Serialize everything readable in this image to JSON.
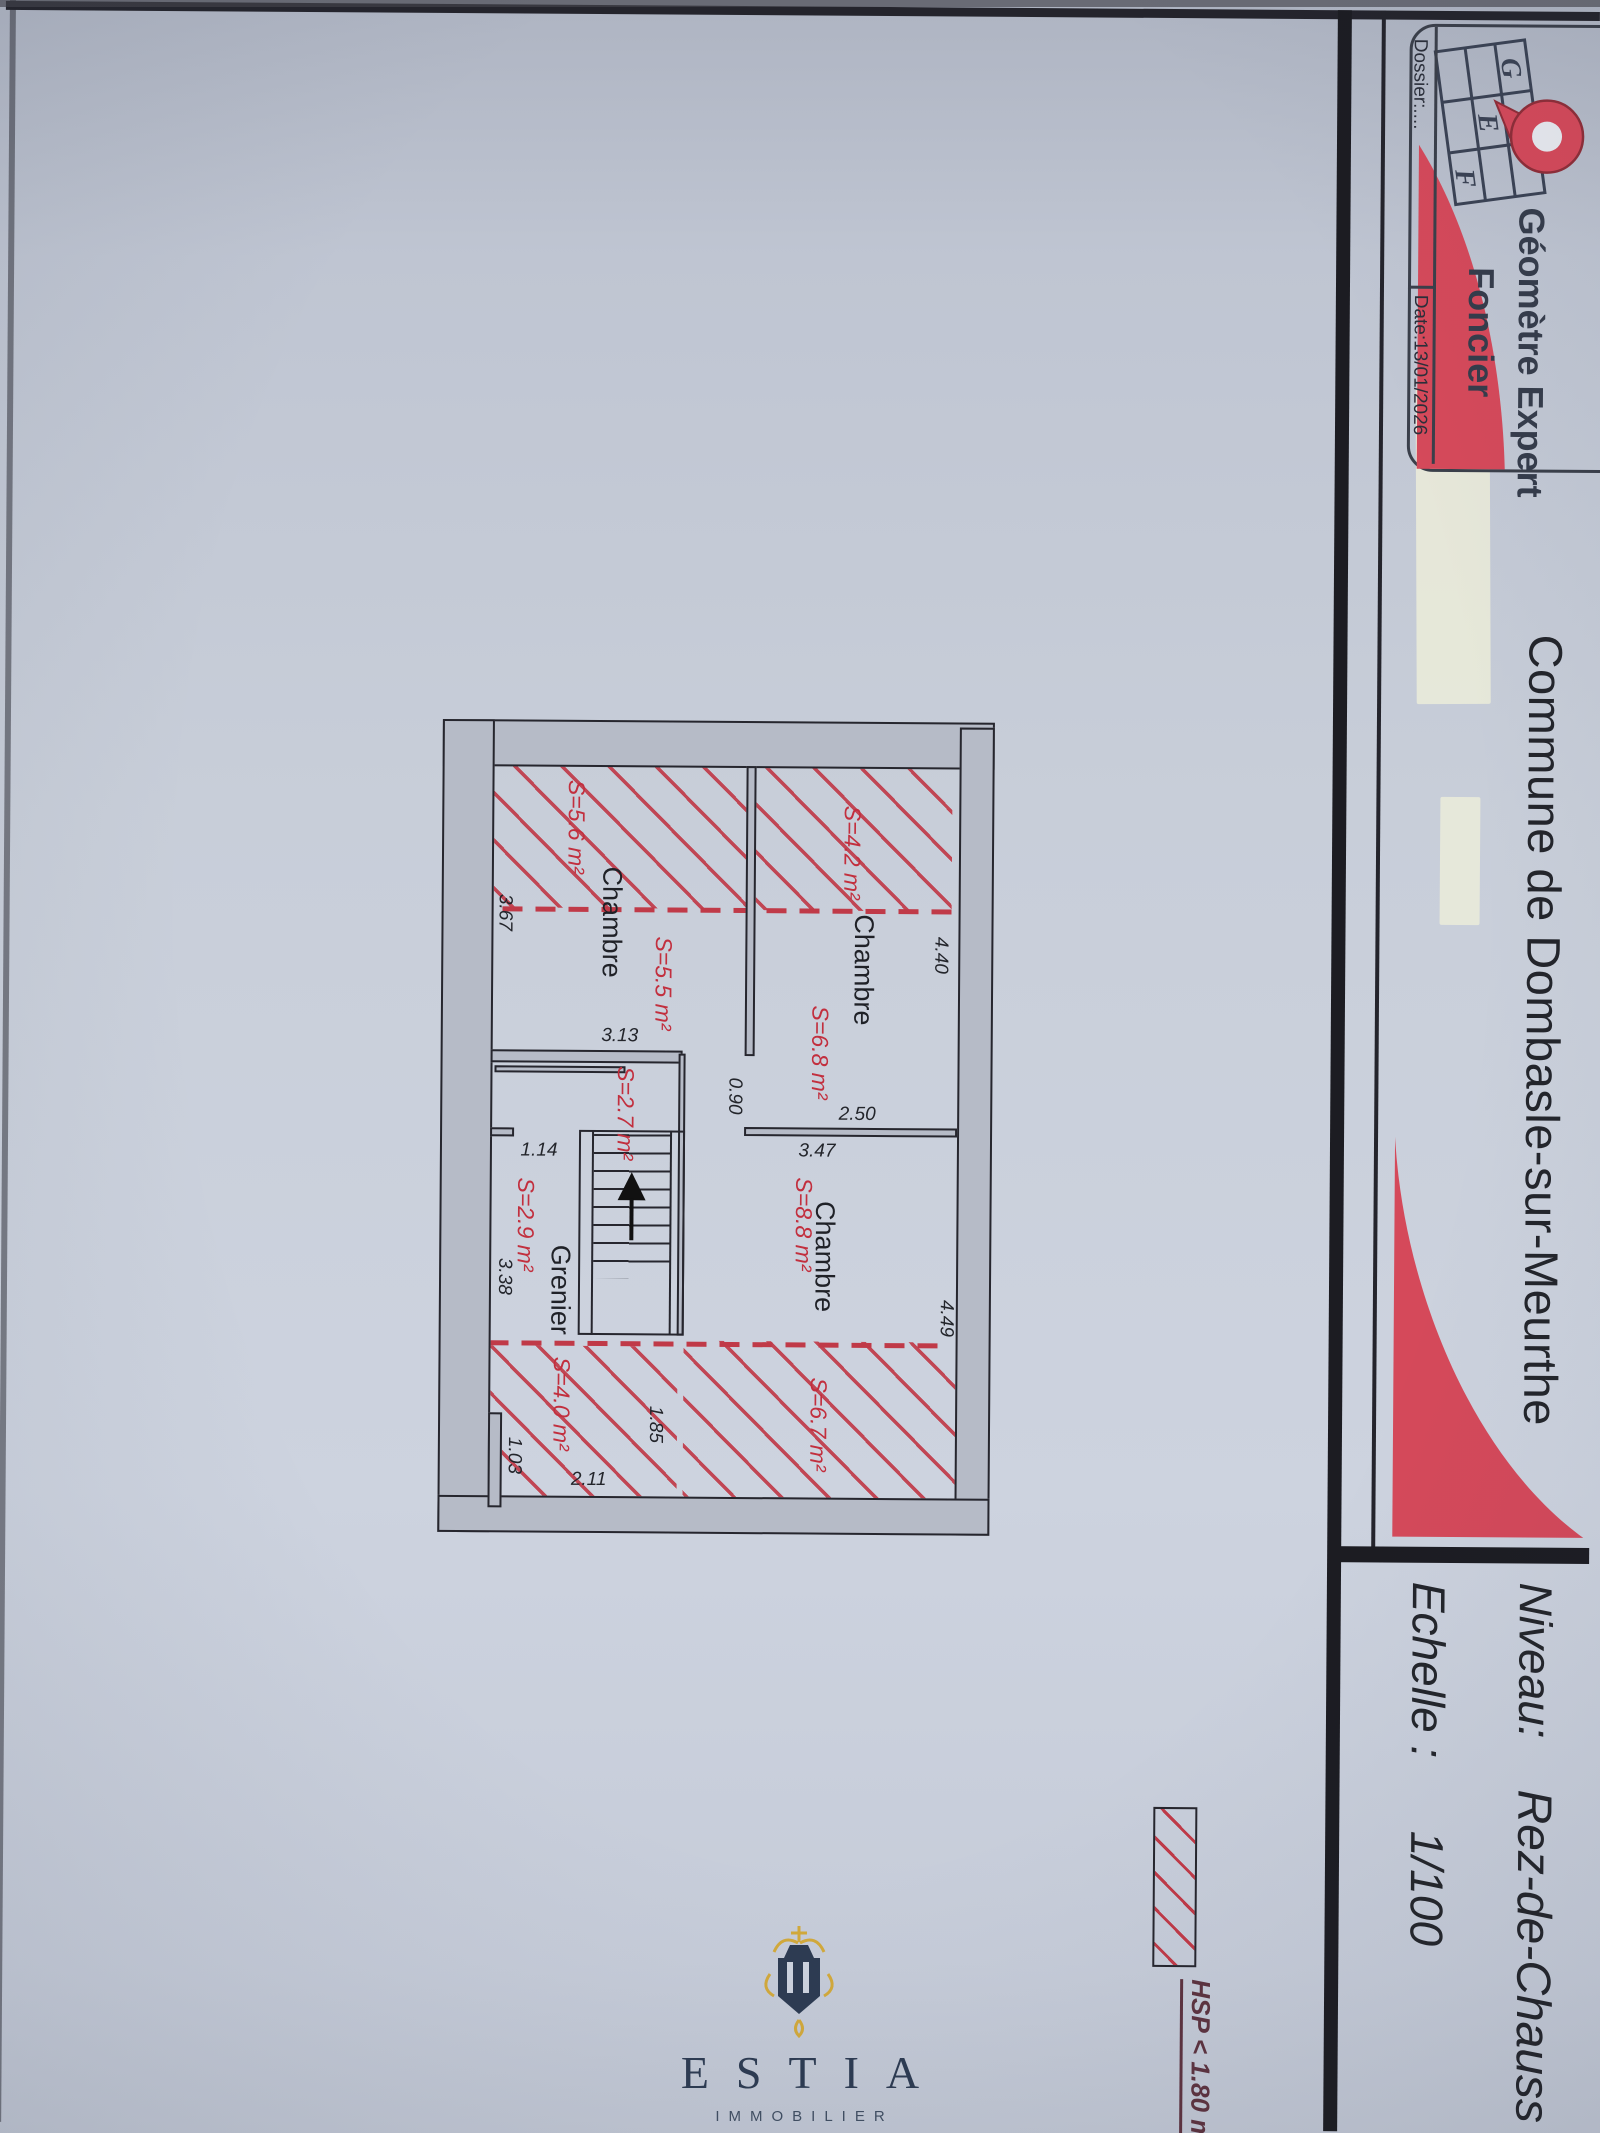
{
  "header": {
    "title": "Commune de Dombasle-sur-Meurthe",
    "logo": {
      "line1": "Géomètre Expert",
      "line2": "Foncier",
      "letters": [
        "G",
        "E",
        "F"
      ],
      "dossier": "Dossier:....",
      "date": "Date:13/01/2026"
    },
    "block": {
      "niveau_label": "Niveau:",
      "niveau_value": "Rez-de-Chauss",
      "echelle_label": "Echelle :",
      "echelle_value": "1/100"
    }
  },
  "legend": {
    "hsp": "HSP < 1.80 m"
  },
  "plan": {
    "rooms": [
      "Chambre",
      "Chambre",
      "Chambre",
      "Grenier"
    ],
    "areas": [
      "S=5.6 m²",
      "S=4.2 m²",
      "S=5.5 m²",
      "S=6.8 m²",
      "S=2.7 m²",
      "S=2.9 m²",
      "S=8.8 m²",
      "S=4.0 m²",
      "S=6.7 m²"
    ],
    "dims": [
      "3.67",
      "3.13",
      "1.14",
      "0.90",
      "2.50",
      "3.47",
      "4.40",
      "4.49",
      "3.38",
      "1.03",
      "2.11",
      "1.85"
    ]
  },
  "watermark": {
    "brand": "ESTIA",
    "sub": "IMMOBILIER"
  },
  "colors": {
    "accent_red": "#d5495a",
    "hatch_red": "#c03a48",
    "ink": "#24242c",
    "estia_navy": "#2d3b52",
    "estia_gold": "#d2a93c"
  }
}
